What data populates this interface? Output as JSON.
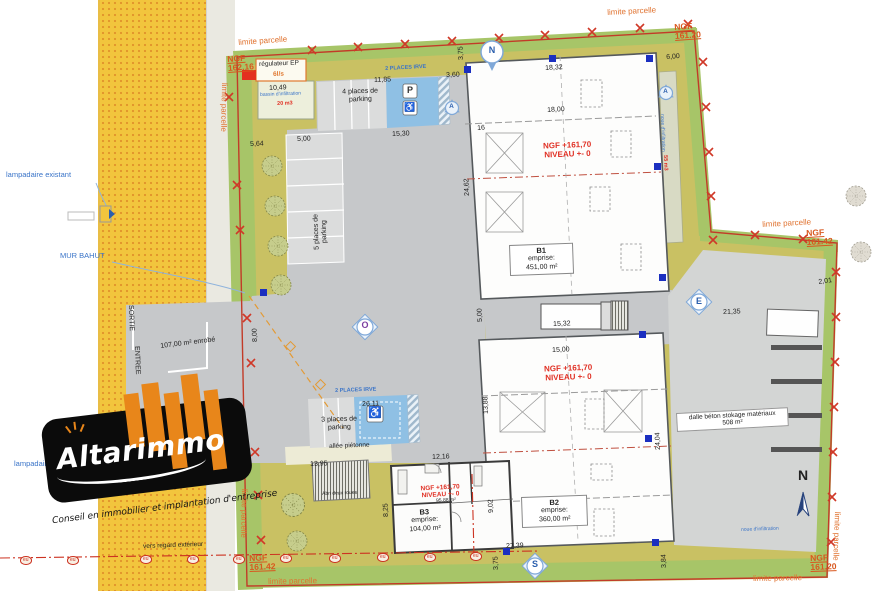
{
  "logo": {
    "brand_altar": "Altar",
    "brand_immo": "immo",
    "tagline": "Conseil en immobilier et implantation d'entreprise"
  },
  "colors": {
    "road_yellow": "#F2C53D",
    "road_dot_orange": "#E0922B",
    "parcel_khaki": "#C9C163",
    "parcel_green_edge": "#A7C568",
    "asphalt_grey": "#C6C8CA",
    "ev_blue": "#8FC0E4",
    "boundary_red": "#C23B28",
    "annotation_orange": "#E0722F",
    "note_blue": "#3A74C8",
    "level_red": "#E03024",
    "logo_orange": "#E8861A"
  },
  "buildings": [
    {
      "code": "B1",
      "emprise_label": "emprise:",
      "area": "451,00 m²"
    },
    {
      "code": "B2",
      "emprise_label": "emprise:",
      "area": "360,00 m²"
    },
    {
      "code": "B3",
      "emprise_label": "emprise:",
      "area": "104,00 m²"
    }
  ],
  "utilities": {
    "eu_label": "eu",
    "eu_positions": [
      [
        20,
        556
      ],
      [
        67,
        556
      ],
      [
        140,
        555
      ],
      [
        187,
        555
      ],
      [
        233,
        555
      ],
      [
        280,
        554
      ],
      [
        329,
        554
      ],
      [
        377,
        553
      ],
      [
        424,
        553
      ],
      [
        470,
        552
      ]
    ]
  },
  "annotations": [
    {
      "t": "limite parcelle",
      "x": 238,
      "y": 38,
      "r": -4,
      "c": "limite"
    },
    {
      "t": "limite parcelle",
      "x": 607,
      "y": 8,
      "r": -3,
      "c": "limite"
    },
    {
      "t": "limite parcelle",
      "x": 762,
      "y": 220,
      "r": -3,
      "c": "limite"
    },
    {
      "t": "limite parcelle",
      "x": 753,
      "y": 574,
      "r": -1,
      "c": "limite"
    },
    {
      "t": "limite parcelle",
      "x": 268,
      "y": 577,
      "r": -1,
      "c": "limite"
    },
    {
      "t": "limite parcelle",
      "x": 842,
      "y": 512,
      "r": 92,
      "c": "limite"
    },
    {
      "t": "limite parcelle",
      "x": 249,
      "y": 489,
      "r": 91,
      "c": "limite"
    },
    {
      "t": "limite parcelle",
      "x": 229,
      "y": 83,
      "r": 91,
      "c": "limite"
    },
    {
      "t": "NGF\n162.16",
      "x": 227,
      "y": 55,
      "r": -4,
      "c": "ngf"
    },
    {
      "t": "NGF\n161.20",
      "x": 674,
      "y": 23,
      "r": -4,
      "c": "ngf"
    },
    {
      "t": "NGF\n161.42",
      "x": 806,
      "y": 229,
      "r": -3,
      "c": "ngf"
    },
    {
      "t": "NGF\n161.20",
      "x": 810,
      "y": 554,
      "r": -2,
      "c": "ngf"
    },
    {
      "t": "NGF\n161.42",
      "x": 249,
      "y": 554,
      "r": -2,
      "c": "ngf"
    },
    {
      "t": "NGF +161,70\nNIVEAU +- 0",
      "x": 527,
      "y": 142,
      "r": -2,
      "c": "level",
      "w": 80
    },
    {
      "t": "NGF +161,70\nNIVEAU +- 0",
      "x": 528,
      "y": 365,
      "r": -2,
      "c": "level",
      "w": 80
    },
    {
      "t": "NGF +161,70\nNIVEAU +- 0",
      "x": 408,
      "y": 486,
      "r": -3,
      "c": "level level-sm",
      "w": 64
    },
    {
      "t": "10,49",
      "x": 269,
      "y": 85,
      "r": -2,
      "c": "dim"
    },
    {
      "t": "11,85",
      "x": 374,
      "y": 77,
      "r": -2,
      "c": "dim"
    },
    {
      "t": "3,60",
      "x": 446,
      "y": 72,
      "r": -2,
      "c": "dim"
    },
    {
      "t": "3,75",
      "x": 458,
      "y": 60,
      "r": -92,
      "c": "dim"
    },
    {
      "t": "6,00",
      "x": 666,
      "y": 54,
      "r": -4,
      "c": "dim"
    },
    {
      "t": "18,32",
      "x": 545,
      "y": 65,
      "r": -3,
      "c": "dim"
    },
    {
      "t": "18,00",
      "x": 547,
      "y": 107,
      "r": -3,
      "c": "dim"
    },
    {
      "t": "16",
      "x": 477,
      "y": 125,
      "r": -3,
      "c": "dim"
    },
    {
      "t": "24,62",
      "x": 464,
      "y": 196,
      "r": -92,
      "c": "dim"
    },
    {
      "t": "15,30",
      "x": 392,
      "y": 131,
      "r": -2,
      "c": "dim"
    },
    {
      "t": "5,00",
      "x": 297,
      "y": 136,
      "r": -2,
      "c": "dim"
    },
    {
      "t": "5,64",
      "x": 250,
      "y": 141,
      "r": -2,
      "c": "dim"
    },
    {
      "t": "8,00",
      "x": 252,
      "y": 342,
      "r": -92,
      "c": "dim"
    },
    {
      "t": "21,35",
      "x": 723,
      "y": 309,
      "r": -2,
      "c": "dim"
    },
    {
      "t": "2,01",
      "x": 818,
      "y": 279,
      "r": -8,
      "c": "dim"
    },
    {
      "t": "15,32",
      "x": 553,
      "y": 321,
      "r": -2,
      "c": "dim"
    },
    {
      "t": "5,00",
      "x": 477,
      "y": 322,
      "r": -92,
      "c": "dim"
    },
    {
      "t": "15,00",
      "x": 552,
      "y": 347,
      "r": -2,
      "c": "dim"
    },
    {
      "t": "13,88",
      "x": 483,
      "y": 414,
      "r": -92,
      "c": "dim"
    },
    {
      "t": "24,04",
      "x": 655,
      "y": 450,
      "r": -92,
      "c": "dim"
    },
    {
      "t": "26,11",
      "x": 362,
      "y": 401,
      "r": -2,
      "c": "dim"
    },
    {
      "t": "13,95",
      "x": 310,
      "y": 461,
      "r": -2,
      "c": "dim"
    },
    {
      "t": "12,16",
      "x": 432,
      "y": 454,
      "r": -2,
      "c": "dim"
    },
    {
      "t": "8,25",
      "x": 383,
      "y": 517,
      "r": -92,
      "c": "dim"
    },
    {
      "t": "9,02",
      "x": 488,
      "y": 513,
      "r": -92,
      "c": "dim"
    },
    {
      "t": "27,39",
      "x": 506,
      "y": 543,
      "r": -2,
      "c": "dim"
    },
    {
      "t": "3,75",
      "x": 493,
      "y": 570,
      "r": -92,
      "c": "dim"
    },
    {
      "t": "3,84",
      "x": 661,
      "y": 568,
      "r": -92,
      "c": "dim"
    },
    {
      "t": "107,00 m² enrobé",
      "x": 160,
      "y": 343,
      "r": -7,
      "c": "dim"
    },
    {
      "t": "SORTIE",
      "x": 134,
      "y": 305,
      "r": 88,
      "c": "dim"
    },
    {
      "t": "ENTREE",
      "x": 140,
      "y": 346,
      "r": 88,
      "c": "dim"
    },
    {
      "t": "lampadaire existant",
      "x": 6,
      "y": 171,
      "r": 0,
      "c": "blue"
    },
    {
      "t": "MUR BAHUT",
      "x": 60,
      "y": 252,
      "r": 0,
      "c": "blue"
    },
    {
      "t": "lampadaire",
      "x": 14,
      "y": 460,
      "r": 0,
      "c": "blue"
    },
    {
      "t": "2 PLACES IRVE",
      "x": 385,
      "y": 66,
      "r": -3,
      "c": "blue blue-sm"
    },
    {
      "t": "2 PLACES IRVE",
      "x": 335,
      "y": 388,
      "r": -2,
      "c": "blue blue-sm"
    },
    {
      "t": "bassin d'infiltration",
      "x": 260,
      "y": 93,
      "r": -2,
      "c": "blue blue-xs"
    },
    {
      "t": "noue d'infiltration",
      "x": 664,
      "y": 114,
      "r": 88,
      "c": "blue blue-xs"
    },
    {
      "t": "noue d'infiltration",
      "x": 741,
      "y": 528,
      "r": -2,
      "c": "blue blue-xs"
    },
    {
      "t": "20 m3",
      "x": 277,
      "y": 101,
      "r": -2,
      "c": "rednote"
    },
    {
      "t": "55 m3",
      "x": 668,
      "y": 155,
      "r": 88,
      "c": "rednote"
    },
    {
      "t": "6l/s",
      "x": 273,
      "y": 71,
      "r": -2,
      "c": "orangenote"
    },
    {
      "t": "régulateur EP",
      "x": 259,
      "y": 61,
      "r": -2,
      "c": "note note-sm"
    },
    {
      "t": "4 places de parking",
      "x": 333,
      "y": 89,
      "r": -2,
      "c": "note note-c",
      "w": 54
    },
    {
      "t": "5 places de parking",
      "x": 314,
      "y": 260,
      "r": -92,
      "c": "note note-c",
      "w": 56
    },
    {
      "t": "3 places de parking",
      "x": 312,
      "y": 417,
      "r": -2,
      "c": "note note-c",
      "w": 54
    },
    {
      "t": "allée piétonne",
      "x": 329,
      "y": 443,
      "r": -2,
      "c": "note note-sm"
    },
    {
      "t": "Abri deux roues",
      "x": 322,
      "y": 492,
      "r": -2,
      "c": "note note-xs"
    },
    {
      "t": "vers regard extérieur",
      "x": 143,
      "y": 543,
      "r": -2,
      "c": "note note-sm"
    },
    {
      "t": "dalle béton stokage matériaux\n508 m²",
      "x": 676,
      "y": 413,
      "r": -3,
      "c": "boxed",
      "w": 104
    },
    {
      "t": "95,88 m²",
      "x": 436,
      "y": 499,
      "r": -3,
      "c": "note note-xs"
    },
    {
      "t": "N",
      "x": 486,
      "y": 45,
      "r": 0,
      "c": "compass",
      "w": 12
    },
    {
      "t": "O",
      "x": 359,
      "y": 320,
      "r": 0,
      "c": "compass compass-o",
      "w": 12
    },
    {
      "t": "E",
      "x": 693,
      "y": 296,
      "r": 0,
      "c": "compass",
      "w": 12
    },
    {
      "t": "S",
      "x": 529,
      "y": 559,
      "r": 0,
      "c": "compass",
      "w": 12
    },
    {
      "t": "A",
      "x": 446,
      "y": 103,
      "r": 0,
      "c": "compassA",
      "w": 11
    },
    {
      "t": "A",
      "x": 660,
      "y": 88,
      "r": 0,
      "c": "compassA",
      "w": 11
    },
    {
      "t": "N",
      "x": 795,
      "y": 467,
      "r": 0,
      "c": "bignorth",
      "w": 16
    },
    {
      "t": "P",
      "x": 403,
      "y": 85,
      "r": 0,
      "c": "picon",
      "w": 14
    },
    {
      "t": "♿",
      "x": 403,
      "y": 102,
      "r": 0,
      "c": "picon",
      "w": 14
    },
    {
      "t": "♿",
      "x": 367,
      "y": 407,
      "r": 0,
      "c": "picon picon-lg",
      "w": 16
    }
  ]
}
